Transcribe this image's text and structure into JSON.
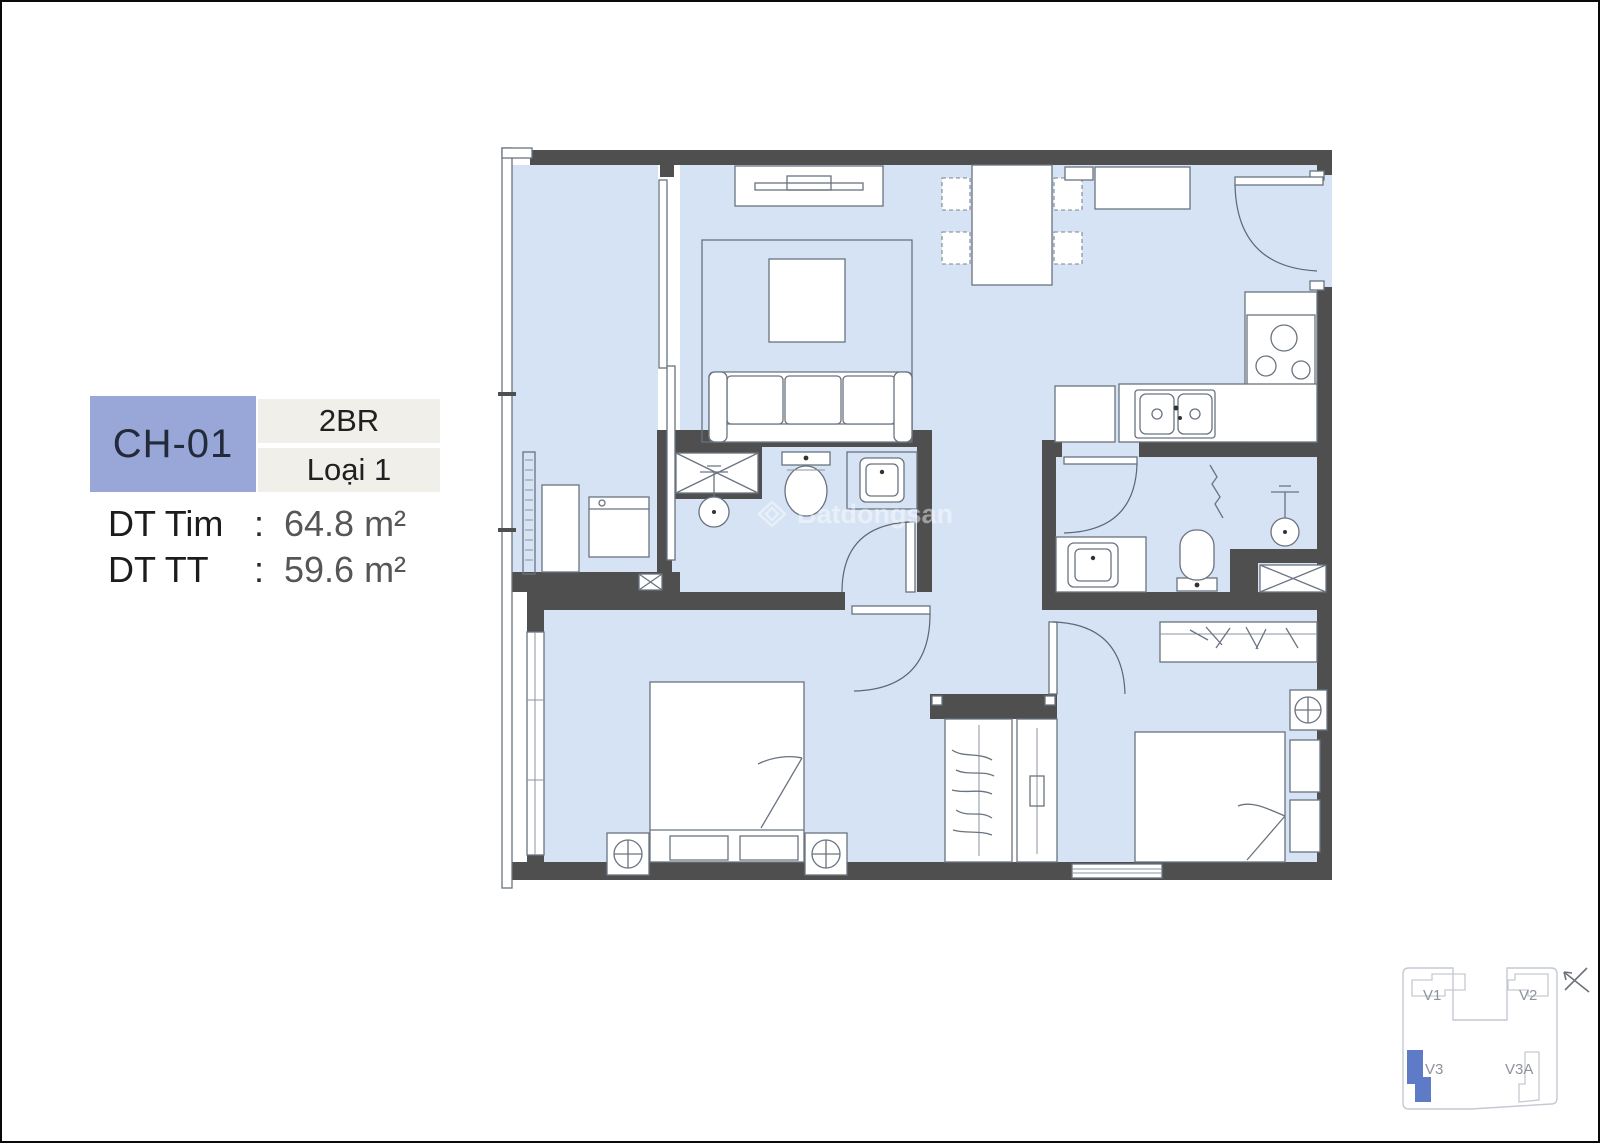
{
  "unit_info": {
    "code": "CH-01",
    "bedrooms": "2BR",
    "variant": "Loại 1",
    "areas": [
      {
        "label": "DT Tim",
        "colon": ":",
        "value": "64.8 m²"
      },
      {
        "label": "DT TT",
        "colon": ":",
        "value": "59.6 m²"
      }
    ]
  },
  "watermark": {
    "brand": "Batdongsan"
  },
  "key_plan": {
    "buildings": [
      {
        "id": "V1",
        "highlighted": false
      },
      {
        "id": "V2",
        "highlighted": false
      },
      {
        "id": "V3",
        "highlighted": true
      },
      {
        "id": "V3A",
        "highlighted": false
      }
    ]
  },
  "colors": {
    "floor": "#d5e3f4",
    "wall": "#4f4f4f",
    "badge": "#98a7d8",
    "tag": "#f0efea",
    "hl": "#5d7bc7"
  }
}
